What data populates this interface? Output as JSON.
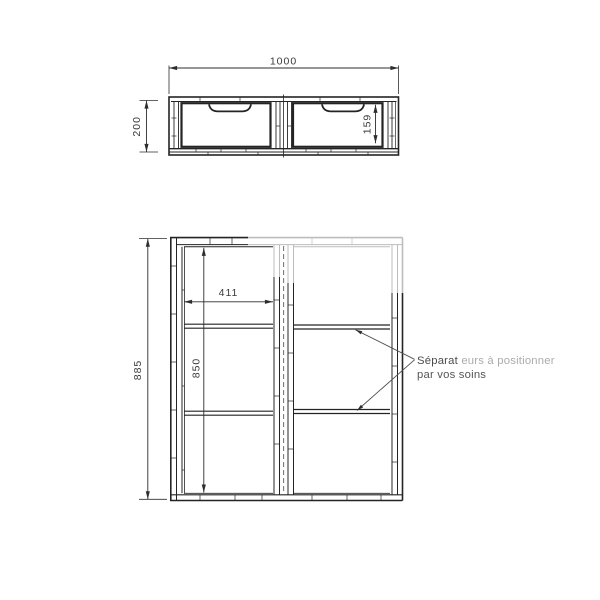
{
  "colors": {
    "line": "#242424",
    "light_line": "#bdbdbd",
    "dim_text": "#3a3a3a",
    "annotation_emphasis": "#4a4a4a",
    "annotation_light": "#ababab",
    "annotation_dark": "#565656",
    "background": "#ffffff"
  },
  "top_view": {
    "width_dim": "1000",
    "height_dim": "200",
    "drawer_depth_dim": "159"
  },
  "front_view": {
    "height_dim": "885",
    "bay_width_dim": "411",
    "bay_interior_height_dim": "850"
  },
  "annotation": {
    "line1_emphasis": "Séparat",
    "line1_rest": "eurs à positionner",
    "line2": "par vos soins"
  }
}
